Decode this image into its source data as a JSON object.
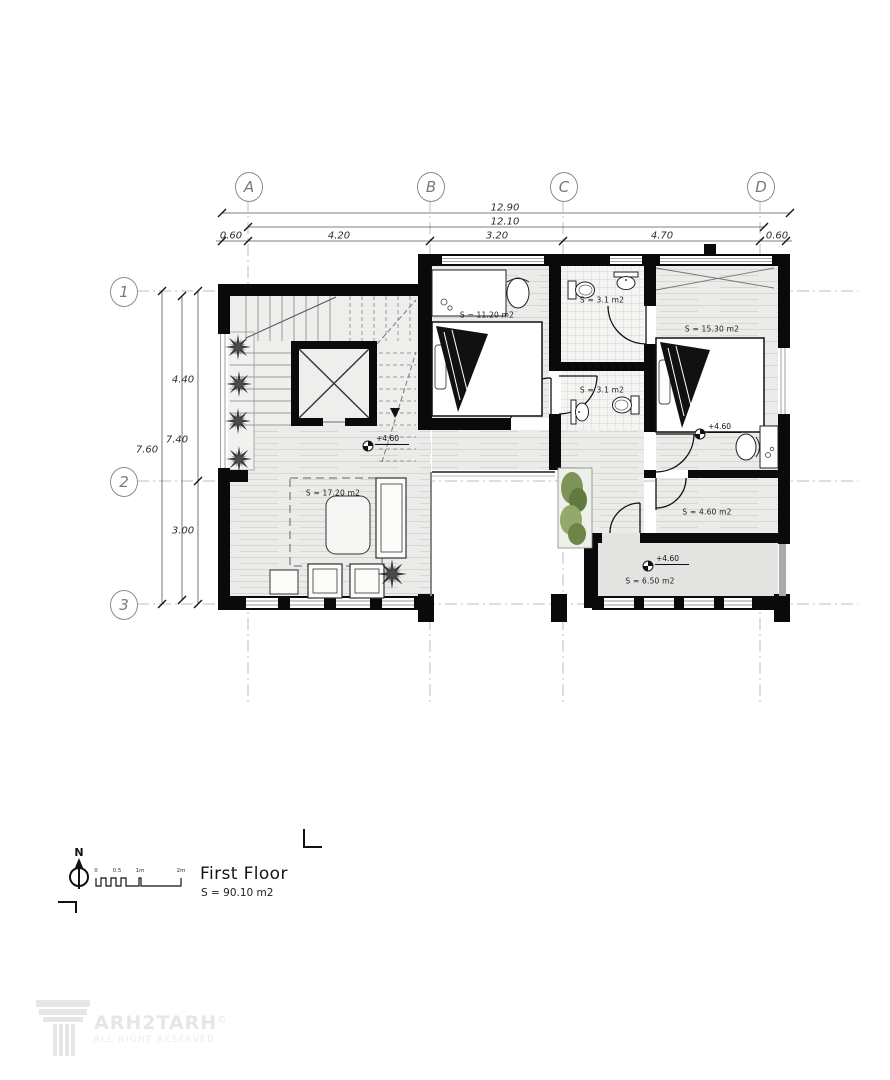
{
  "grid": {
    "columns": [
      "A",
      "B",
      "C",
      "D"
    ],
    "rows": [
      "1",
      "2",
      "3"
    ]
  },
  "dims": {
    "h_total": "12.90",
    "h_inner": "12.10",
    "h_segs": [
      "0.60",
      "4.20",
      "3.20",
      "4.70",
      "0.60"
    ],
    "v_total": "7.60",
    "v_inner": "7.40",
    "v_segs": [
      "4.40",
      "3.00"
    ]
  },
  "rooms": {
    "bedroom1": "S = 11.20 m2",
    "bath1": "S = 3.1 m2",
    "bath2": "S = 3.1 m2",
    "bedroom2": "S = 15.30 m2",
    "living": "S = 17.20 m2",
    "closet": "S = 4.60 m2",
    "terrace": "S = 6.50 m2"
  },
  "levels": {
    "hall": "+4.60",
    "bedroom2": "+4.60",
    "terrace": "+4.60"
  },
  "north_label": "N",
  "scalebar": {
    "ticks": [
      "0",
      "0.5",
      "1m",
      "2m"
    ]
  },
  "title_block": {
    "title": "First Floor",
    "area": "S = 90.10 m2"
  },
  "logo": {
    "brand": "ARH2TARH",
    "mark": "©",
    "tagline": "ALL RIGHT RESERVED"
  },
  "colors": {
    "wall": "#0a0a0a",
    "wood_floor": "#ebebe9",
    "tile_floor": "#f4f4f2",
    "terrace_floor": "#e3e3e1",
    "grid_line": "#bdbdbd",
    "plant_green": "#7d9457",
    "logo_gray": "#e6e6e6"
  }
}
